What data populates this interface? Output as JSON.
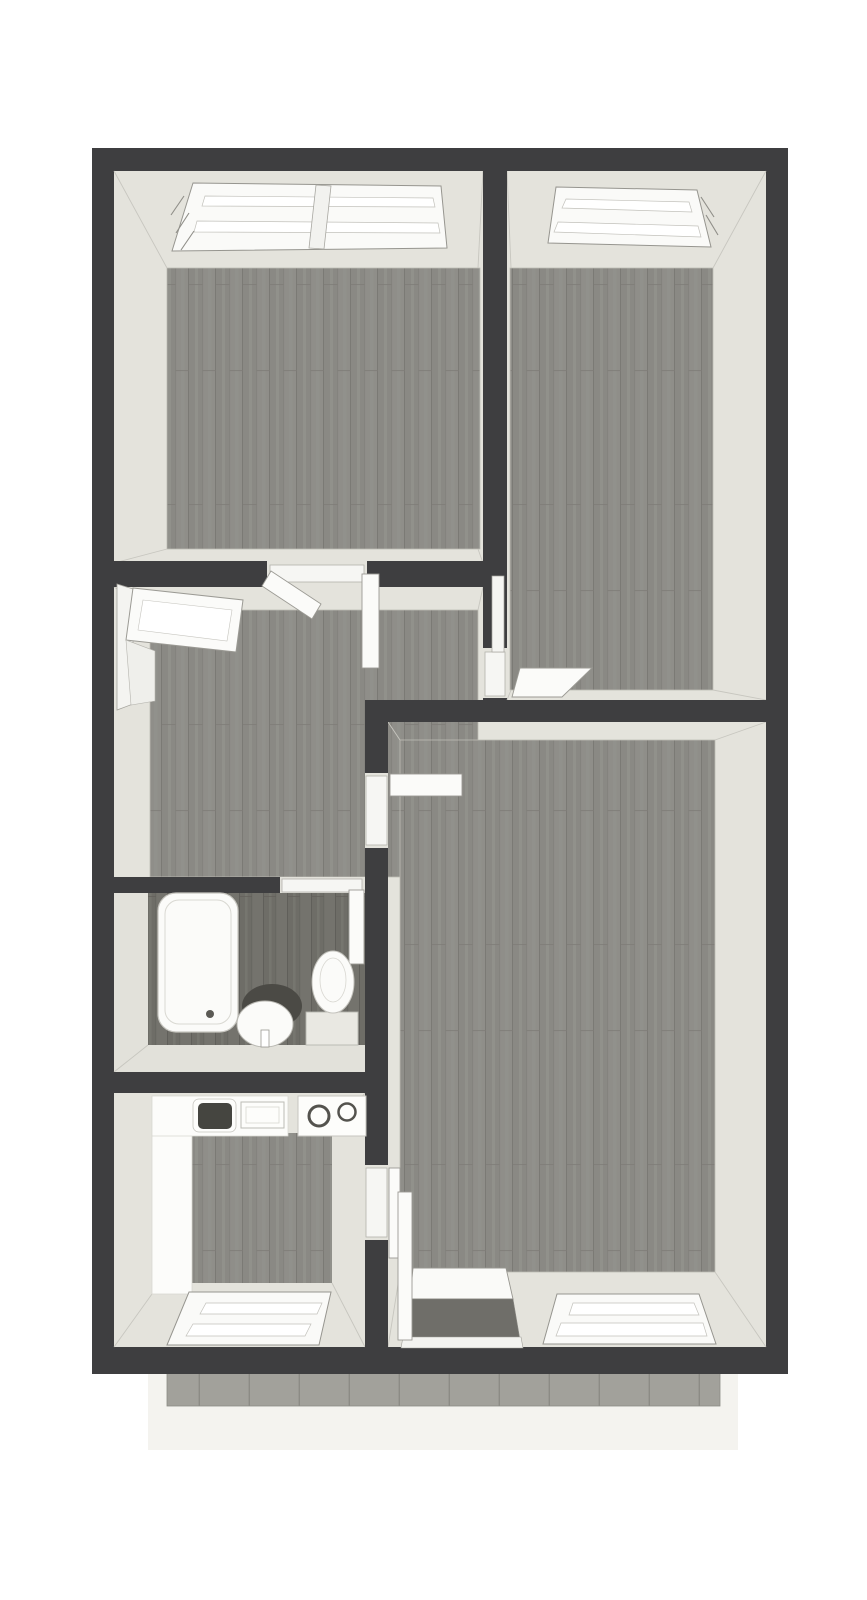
{
  "meta": {
    "type": "3d-floor-plan-top-view",
    "canvas_width": 867,
    "canvas_height": 1600,
    "text_visible": false
  },
  "palette": {
    "wall": "#3e3e40",
    "wall_face": "#e4e3dc",
    "wall_face_dim": "#e2e1da",
    "floor_wood": "#8f8e89",
    "floor_wood_dark": "#74736d",
    "balcony_tile": "#a2a19b",
    "balcony_apron": "#f4f3ef",
    "fixture_white": "#fbfbf9",
    "threshold_white": "#f6f6f3",
    "background": "#ffffff"
  },
  "rooms": [
    {
      "id": "bedroom-top-left",
      "floor": "wood",
      "features": [
        "double-window-north",
        "double-door-to-hall"
      ]
    },
    {
      "id": "bedroom-top-right",
      "floor": "wood",
      "features": [
        "window-north",
        "door-to-hall"
      ]
    },
    {
      "id": "hall",
      "floor": "wood",
      "features": [
        "open-window-west"
      ]
    },
    {
      "id": "bathroom",
      "floor": "wood-dark",
      "features": [
        "bathtub",
        "washbasin",
        "toilet",
        "door-north"
      ]
    },
    {
      "id": "kitchen",
      "floor": "wood",
      "features": [
        "l-shaped-counter",
        "sink-unit",
        "cooktop-two-burners",
        "window-south",
        "door-to-living-room"
      ]
    },
    {
      "id": "living-room",
      "floor": "wood",
      "features": [
        "balcony-door-south",
        "window-south",
        "door-to-hall"
      ]
    },
    {
      "id": "balcony",
      "floor": "tile",
      "features": []
    }
  ],
  "scene": [
    {
      "n": "balcony-apron",
      "s": "rect",
      "x": 148,
      "y": 1372,
      "w": 590,
      "h": 78,
      "f": "#f4f3ef"
    },
    {
      "n": "balcony-tile-floor",
      "s": "rect",
      "x": 167,
      "y": 1372,
      "w": 553,
      "h": 34,
      "f": "pattern:tiles",
      "st": "#8d8c86",
      "sw": 0.8
    },
    {
      "n": "exterior-walls",
      "s": "rect",
      "x": 92,
      "y": 148,
      "w": 696,
      "h": 1226,
      "f": "#3e3e40"
    },
    {
      "n": "bedroom1-wall-faces",
      "s": "rect",
      "x": 114,
      "y": 171,
      "w": 369,
      "h": 392,
      "f": "#e4e3dc"
    },
    {
      "n": "bedroom2-wall-faces",
      "s": "rect",
      "x": 507,
      "y": 171,
      "w": 259,
      "h": 529,
      "f": "#e4e3dc"
    },
    {
      "n": "hall-wall-faces",
      "s": "rect",
      "x": 114,
      "y": 587,
      "w": 369,
      "h": 290,
      "f": "#e4e3dc"
    },
    {
      "n": "bathroom-wall-faces",
      "s": "rect",
      "x": 114,
      "y": 893,
      "w": 274,
      "h": 179,
      "f": "#e2e1da"
    },
    {
      "n": "kitchen-wall-faces",
      "s": "rect",
      "x": 114,
      "y": 1093,
      "w": 274,
      "h": 254,
      "f": "#e4e3dc"
    },
    {
      "n": "living-wall-faces",
      "s": "rect",
      "x": 388,
      "y": 722,
      "w": 378,
      "h": 625,
      "f": "#e4e3dc"
    },
    {
      "n": "bedroom1-floor",
      "s": "rect",
      "x": 167,
      "y": 268,
      "w": 313,
      "h": 281,
      "f": "pattern:wood",
      "st": "#bdbcb5",
      "sw": 0.8
    },
    {
      "n": "bedroom2-floor",
      "s": "rect",
      "x": 510,
      "y": 268,
      "w": 203,
      "h": 422,
      "f": "pattern:wood",
      "st": "#bdbcb5",
      "sw": 0.8
    },
    {
      "n": "hall-floor",
      "s": "rect",
      "x": 150,
      "y": 610,
      "w": 328,
      "h": 267,
      "f": "pattern:wood",
      "st": "#bdbcb5",
      "sw": 0.8
    },
    {
      "n": "bathroom-floor",
      "s": "rect",
      "x": 148,
      "y": 893,
      "w": 217,
      "h": 152,
      "f": "pattern:woodDark"
    },
    {
      "n": "kitchen-floor",
      "s": "rect",
      "x": 192,
      "y": 1133,
      "w": 140,
      "h": 150,
      "f": "pattern:wood"
    },
    {
      "n": "living-floor",
      "s": "rect",
      "x": 400,
      "y": 740,
      "w": 315,
      "h": 532,
      "f": "pattern:wood",
      "st": "#bdbcb5",
      "sw": 0.8
    },
    {
      "n": "corner-seam",
      "s": "line",
      "x1": 114,
      "y1": 171,
      "x2": 167,
      "y2": 268,
      "st": "#c7c6bf",
      "sw": 0.9
    },
    {
      "n": "corner-seam",
      "s": "line",
      "x1": 483,
      "y1": 171,
      "x2": 478,
      "y2": 268,
      "st": "#c7c6bf",
      "sw": 0.9
    },
    {
      "n": "corner-seam",
      "s": "line",
      "x1": 114,
      "y1": 563,
      "x2": 167,
      "y2": 549,
      "st": "#c7c6bf",
      "sw": 0.9
    },
    {
      "n": "corner-seam",
      "s": "line",
      "x1": 483,
      "y1": 563,
      "x2": 478,
      "y2": 549,
      "st": "#c7c6bf",
      "sw": 0.9
    },
    {
      "n": "corner-seam",
      "s": "line",
      "x1": 507,
      "y1": 171,
      "x2": 511,
      "y2": 268,
      "st": "#c7c6bf",
      "sw": 0.9
    },
    {
      "n": "corner-seam",
      "s": "line",
      "x1": 766,
      "y1": 171,
      "x2": 713,
      "y2": 268,
      "st": "#c7c6bf",
      "sw": 0.9
    },
    {
      "n": "corner-seam",
      "s": "line",
      "x1": 766,
      "y1": 700,
      "x2": 713,
      "y2": 690,
      "st": "#c7c6bf",
      "sw": 0.9
    },
    {
      "n": "corner-seam",
      "s": "line",
      "x1": 507,
      "y1": 700,
      "x2": 511,
      "y2": 690,
      "st": "#c7c6bf",
      "sw": 0.9
    },
    {
      "n": "corner-seam",
      "s": "line",
      "x1": 114,
      "y1": 587,
      "x2": 150,
      "y2": 610,
      "st": "#c7c6bf",
      "sw": 0.9
    },
    {
      "n": "corner-seam",
      "s": "line",
      "x1": 483,
      "y1": 587,
      "x2": 478,
      "y2": 610,
      "st": "#c7c6bf",
      "sw": 0.9
    },
    {
      "n": "corner-seam",
      "s": "line",
      "x1": 388,
      "y1": 722,
      "x2": 400,
      "y2": 740,
      "st": "#c7c6bf",
      "sw": 0.9
    },
    {
      "n": "corner-seam",
      "s": "line",
      "x1": 766,
      "y1": 722,
      "x2": 715,
      "y2": 740,
      "st": "#c7c6bf",
      "sw": 0.9
    },
    {
      "n": "corner-seam",
      "s": "line",
      "x1": 766,
      "y1": 1347,
      "x2": 715,
      "y2": 1272,
      "st": "#c7c6bf",
      "sw": 0.9
    },
    {
      "n": "corner-seam",
      "s": "line",
      "x1": 388,
      "y1": 1347,
      "x2": 400,
      "y2": 1272,
      "st": "#c7c6bf",
      "sw": 0.9
    },
    {
      "n": "corner-seam",
      "s": "line",
      "x1": 114,
      "y1": 1072,
      "x2": 148,
      "y2": 1045,
      "st": "#c7c6bf",
      "sw": 0.9
    },
    {
      "n": "corner-seam",
      "s": "line",
      "x1": 365,
      "y1": 1093,
      "x2": 332,
      "y2": 1133,
      "st": "#c7c6bf",
      "sw": 0.9
    },
    {
      "n": "corner-seam",
      "s": "line",
      "x1": 365,
      "y1": 1347,
      "x2": 332,
      "y2": 1283,
      "st": "#c7c6bf",
      "sw": 0.9
    },
    {
      "n": "corner-seam",
      "s": "line",
      "x1": 114,
      "y1": 1347,
      "x2": 152,
      "y2": 1294,
      "st": "#c7c6bf",
      "sw": 0.9
    },
    {
      "n": "wall-bedroom-divider",
      "s": "rect",
      "x": 483,
      "y": 148,
      "w": 24,
      "h": 500,
      "f": "#3e3e40"
    },
    {
      "n": "wall-bedroom1-south-left",
      "s": "rect",
      "x": 114,
      "y": 561,
      "w": 153,
      "h": 26,
      "f": "#3e3e40"
    },
    {
      "n": "wall-bedroom1-south-right",
      "s": "rect",
      "x": 367,
      "y": 561,
      "w": 116,
      "h": 26,
      "f": "#3e3e40"
    },
    {
      "n": "wall-living-north",
      "s": "rect",
      "x": 365,
      "y": 700,
      "w": 423,
      "h": 22,
      "f": "#3e3e40"
    },
    {
      "n": "wall-hall-living-upper",
      "s": "rect",
      "x": 365,
      "y": 722,
      "w": 23,
      "h": 51,
      "f": "#3e3e40"
    },
    {
      "n": "wall-hall-living-mid",
      "s": "rect",
      "x": 365,
      "y": 848,
      "w": 23,
      "h": 317,
      "f": "#3e3e40"
    },
    {
      "n": "wall-kitchen-living-lower",
      "s": "rect",
      "x": 365,
      "y": 1240,
      "w": 23,
      "h": 107,
      "f": "#3e3e40"
    },
    {
      "n": "wall-bathroom-north",
      "s": "rect",
      "x": 114,
      "y": 877,
      "w": 166,
      "h": 16,
      "f": "#3e3e40"
    },
    {
      "n": "wall-bathroom-south",
      "s": "rect",
      "x": 114,
      "y": 1072,
      "w": 251,
      "h": 21,
      "f": "#3e3e40"
    },
    {
      "n": "doorway-bedroom1",
      "s": "rect",
      "x": 267,
      "y": 561,
      "w": 100,
      "h": 26,
      "f": "#e4e3dc"
    },
    {
      "n": "doorway-bedroom1-threshold",
      "s": "rect",
      "x": 270,
      "y": 565,
      "w": 94,
      "h": 17,
      "f": "#f6f6f3",
      "st": "#b3b2ac",
      "sw": 0.8
    },
    {
      "n": "doorway-bedroom2",
      "s": "rect",
      "x": 483,
      "y": 648,
      "w": 24,
      "h": 50,
      "f": "#e4e3dc"
    },
    {
      "n": "doorway-bedroom2-threshold",
      "s": "rect",
      "x": 485,
      "y": 652,
      "w": 20,
      "h": 44,
      "f": "#f6f6f3",
      "st": "#b3b2ac",
      "sw": 0.8
    },
    {
      "n": "doorway-bedroom2-frame",
      "s": "rect",
      "x": 492,
      "y": 576,
      "w": 12,
      "h": 76,
      "f": "#f5f5f2",
      "st": "#a5a49e",
      "sw": 0.7
    },
    {
      "n": "doorway-hall-living",
      "s": "rect",
      "x": 365,
      "y": 773,
      "w": 23,
      "h": 75,
      "f": "#e4e3dc"
    },
    {
      "n": "doorway-hall-living-threshold",
      "s": "rect",
      "x": 366,
      "y": 776,
      "w": 21,
      "h": 69,
      "f": "#f6f6f3",
      "st": "#b3b2ac",
      "sw": 0.8
    },
    {
      "n": "doorway-kitchen-living",
      "s": "rect",
      "x": 365,
      "y": 1165,
      "w": 23,
      "h": 75,
      "f": "#e4e3dc"
    },
    {
      "n": "doorway-kitchen-living-threshold",
      "s": "rect",
      "x": 366,
      "y": 1168,
      "w": 21,
      "h": 69,
      "f": "#f6f6f3",
      "st": "#b3b2ac",
      "sw": 0.8
    },
    {
      "n": "doorway-bathroom",
      "s": "rect",
      "x": 280,
      "y": 877,
      "w": 85,
      "h": 16,
      "f": "#e2e1da"
    },
    {
      "n": "doorway-bathroom-threshold",
      "s": "rect",
      "x": 282,
      "y": 879,
      "w": 80,
      "h": 13,
      "f": "#f6f6f3",
      "st": "#b3b2ac",
      "sw": 0.8
    },
    {
      "n": "bedroom1-window-frame",
      "s": "poly",
      "p": "193,183 441,186 447,248 172,251",
      "f": "#fafaf8",
      "st": "#96958f",
      "sw": 1
    },
    {
      "n": "bedroom1-window-rail-top",
      "s": "poly",
      "p": "205,196 433,198 435,207 202,206",
      "f": "#ffffff",
      "st": "#c2c1bb",
      "sw": 0.7
    },
    {
      "n": "bedroom1-window-rail-bottom",
      "s": "poly",
      "p": "197,221 438,223 440,233 194,232",
      "f": "#ffffff",
      "st": "#c2c1bb",
      "sw": 0.7
    },
    {
      "n": "bedroom1-window-mullion",
      "s": "poly",
      "p": "316,185 331,186 324,249 309,248",
      "f": "#f2f2ef",
      "st": "#a8a7a1",
      "sw": 0.8
    },
    {
      "n": "window-jamb-tick",
      "s": "line",
      "x1": 184,
      "y1": 196,
      "x2": 171,
      "y2": 215,
      "st": "#8f8e88",
      "sw": 1.1
    },
    {
      "n": "window-jamb-tick",
      "s": "line",
      "x1": 189,
      "y1": 213,
      "x2": 176,
      "y2": 233,
      "st": "#8f8e88",
      "sw": 1.1
    },
    {
      "n": "window-jamb-tick",
      "s": "line",
      "x1": 194,
      "y1": 231,
      "x2": 181,
      "y2": 250,
      "st": "#8f8e88",
      "sw": 1.1
    },
    {
      "n": "bedroom2-window-frame",
      "s": "poly",
      "p": "556,187 697,190 711,247 548,243",
      "f": "#fafaf8",
      "st": "#96958f",
      "sw": 1
    },
    {
      "n": "bedroom2-window-rail-top",
      "s": "poly",
      "p": "566,199 689,202 692,212 562,208",
      "f": "#ffffff",
      "st": "#c2c1bb",
      "sw": 0.7
    },
    {
      "n": "bedroom2-window-rail-bottom",
      "s": "poly",
      "p": "558,222 698,226 701,237 554,232",
      "f": "#ffffff",
      "st": "#c2c1bb",
      "sw": 0.7
    },
    {
      "n": "window-jamb-tick",
      "s": "line",
      "x1": 701,
      "y1": 197,
      "x2": 714,
      "y2": 217,
      "st": "#8f8e88",
      "sw": 1.1
    },
    {
      "n": "window-jamb-tick",
      "s": "line",
      "x1": 706,
      "y1": 215,
      "x2": 718,
      "y2": 235,
      "st": "#8f8e88",
      "sw": 1.1
    },
    {
      "n": "hall-window-jamb",
      "s": "poly",
      "p": "117,584 133,589 133,704 117,710",
      "f": "#f4f4f1",
      "st": "#a5a49e",
      "sw": 0.8
    },
    {
      "n": "hall-window-open-sash",
      "s": "poly",
      "p": "133,588 243,600 236,652 126,640",
      "f": "#fbfbf9",
      "st": "#9b9a94",
      "sw": 1
    },
    {
      "n": "hall-window-sash-glass",
      "s": "poly",
      "p": "143,600 232,610 227,641 138,630",
      "f": "#ffffff",
      "st": "#c5c4be",
      "sw": 0.6
    },
    {
      "n": "hall-window-reveal",
      "s": "poly",
      "p": "126,640 155,651 155,701 131,705",
      "f": "#efefeb",
      "st": "#b5b4ae",
      "sw": 0.6
    },
    {
      "n": "bedroom1-door-leaf-left",
      "s": "poly",
      "p": "271,571 321,604 312,619 262,586",
      "f": "#fbfbf9",
      "st": "#9b9a94",
      "sw": 0.9
    },
    {
      "n": "bedroom1-door-leaf-right",
      "s": "rect",
      "x": 362,
      "y": 574,
      "w": 17,
      "h": 94,
      "f": "#fbfbf9",
      "st": "#9b9a94",
      "sw": 0.9
    },
    {
      "n": "bedroom2-door-leaf",
      "s": "poly",
      "p": "520,668 592,668 562,697 512,697",
      "f": "#fbfbf9",
      "st": "#9b9a94",
      "sw": 0.9
    },
    {
      "n": "hall-living-door-leaf",
      "s": "rect",
      "x": 390,
      "y": 774,
      "w": 72,
      "h": 22,
      "f": "#fbfbf9",
      "st": "#9b9a94",
      "sw": 0.9
    },
    {
      "n": "bathroom-door-leaf",
      "s": "rect",
      "x": 349,
      "y": 890,
      "w": 15,
      "h": 74,
      "f": "#fbfbf9",
      "st": "#9b9a94",
      "sw": 0.9
    },
    {
      "n": "kitchen-door-leaf",
      "s": "rect",
      "x": 389,
      "y": 1168,
      "w": 11,
      "h": 90,
      "f": "#fbfbf9",
      "st": "#9b9a94",
      "sw": 0.9
    },
    {
      "n": "bathtub",
      "s": "rect",
      "x": 158,
      "y": 893,
      "w": 80,
      "h": 139,
      "rx": 18,
      "f": "#fbfbf9",
      "st": "#c7c6c0",
      "sw": 1.2
    },
    {
      "n": "bathtub-inner-rim",
      "s": "rect",
      "x": 165,
      "y": 900,
      "w": 66,
      "h": 124,
      "rx": 14,
      "f": "none",
      "st": "#d9d8d2",
      "sw": 1
    },
    {
      "n": "bathtub-drain",
      "s": "circle",
      "cx": 210,
      "cy": 1014,
      "r": 4,
      "f": "#5b5a55"
    },
    {
      "n": "washbasin-backsplash",
      "s": "ellipse",
      "cx": 272,
      "cy": 1006,
      "rx": 30,
      "ry": 22,
      "f": "#4b4a45"
    },
    {
      "n": "washbasin-bowl",
      "s": "ellipse",
      "cx": 265,
      "cy": 1024,
      "rx": 28,
      "ry": 23,
      "f": "#fbfbf9",
      "st": "#b9b8b2",
      "sw": 1
    },
    {
      "n": "washbasin-tap",
      "s": "rect",
      "x": 261,
      "y": 1030,
      "w": 8,
      "h": 17,
      "f": "#ffffff",
      "st": "#9b9a94",
      "sw": 0.8
    },
    {
      "n": "toilet-base",
      "s": "rect",
      "x": 306,
      "y": 1012,
      "w": 52,
      "h": 33,
      "f": "#e9e8e2",
      "st": "#b7b6b0",
      "sw": 0.9
    },
    {
      "n": "toilet-bowl",
      "s": "ellipse",
      "cx": 333,
      "cy": 982,
      "rx": 21,
      "ry": 31,
      "f": "#fbfbf9",
      "st": "#c4c3bd",
      "sw": 1
    },
    {
      "n": "toilet-bowl-inner",
      "s": "ellipse",
      "cx": 333,
      "cy": 980,
      "rx": 13,
      "ry": 22,
      "f": "none",
      "st": "#d8d7d1",
      "sw": 0.8
    },
    {
      "n": "kitchen-counter-left",
      "s": "rect",
      "x": 152,
      "y": 1096,
      "w": 40,
      "h": 198,
      "f": "#fcfcfa",
      "st": "#d8d7d1",
      "sw": 0.8
    },
    {
      "n": "kitchen-counter-top",
      "s": "rect",
      "x": 152,
      "y": 1096,
      "w": 136,
      "h": 40,
      "f": "#fcfcfa",
      "st": "#d8d7d1",
      "sw": 0.8
    },
    {
      "n": "kitchen-sink-unit",
      "s": "rect",
      "x": 193,
      "y": 1099,
      "w": 43,
      "h": 33,
      "rx": 6,
      "f": "#fdfdfb",
      "st": "#c6c5bf",
      "sw": 0.8
    },
    {
      "n": "kitchen-sink-basin",
      "s": "rect",
      "x": 198,
      "y": 1103,
      "w": 34,
      "h": 26,
      "rx": 5,
      "f": "#454540"
    },
    {
      "n": "kitchen-drainboard",
      "s": "rect",
      "x": 241,
      "y": 1102,
      "w": 43,
      "h": 26,
      "f": "#fdfdfb",
      "st": "#bcbbb5",
      "sw": 1
    },
    {
      "n": "kitchen-drainboard-inner",
      "s": "rect",
      "x": 246,
      "y": 1107,
      "w": 33,
      "h": 16,
      "f": "none",
      "st": "#d8d7d1",
      "sw": 0.8
    },
    {
      "n": "kitchen-stove",
      "s": "rect",
      "x": 298,
      "y": 1096,
      "w": 68,
      "h": 40,
      "f": "#fdfdfb",
      "st": "#c6c5bf",
      "sw": 1
    },
    {
      "n": "stove-burner-left",
      "s": "circle",
      "cx": 319,
      "cy": 1116,
      "r": 10,
      "f": "#fdfdfb",
      "st": "#54534e",
      "sw": 3
    },
    {
      "n": "stove-burner-right",
      "s": "circle",
      "cx": 347,
      "cy": 1112,
      "r": 8.5,
      "f": "#fdfdfb",
      "st": "#54534e",
      "sw": 2.5
    },
    {
      "n": "balcony-door-sill",
      "s": "poly",
      "p": "413,1268 506,1268 513,1299 410,1299",
      "f": "#fafaf8",
      "st": "#96958f",
      "sw": 0.9
    },
    {
      "n": "balcony-door-glass",
      "s": "poly",
      "p": "410,1299 513,1299 520,1340 404,1340",
      "f": "#6f6e69",
      "st": "#8a8984",
      "sw": 0.6
    },
    {
      "n": "balcony-door-bottom-rail",
      "s": "poly",
      "p": "403,1337 521,1337 523,1348 401,1348",
      "f": "#f3f3f0",
      "st": "#a09f99",
      "sw": 0.6
    },
    {
      "n": "balcony-door-open-leaf",
      "s": "rect",
      "x": 398,
      "y": 1192,
      "w": 14,
      "h": 148,
      "f": "#fbfbf9",
      "st": "#9b9a94",
      "sw": 0.9
    },
    {
      "n": "living-window-frame",
      "s": "poly",
      "p": "557,1294 699,1294 716,1344 543,1344",
      "f": "#fafaf8",
      "st": "#96958f",
      "sw": 1
    },
    {
      "n": "living-window-rail-top",
      "s": "poly",
      "p": "573,1303 694,1303 699,1315 569,1315",
      "f": "#ffffff",
      "st": "#c2c1bb",
      "sw": 0.7
    },
    {
      "n": "living-window-rail-bottom",
      "s": "poly",
      "p": "561,1323 703,1323 707,1336 556,1336",
      "f": "#ffffff",
      "st": "#c2c1bb",
      "sw": 0.7
    },
    {
      "n": "kitchen-window-frame",
      "s": "poly",
      "p": "189,1292 331,1292 319,1345 167,1345",
      "f": "#fafaf8",
      "st": "#96958f",
      "sw": 1
    },
    {
      "n": "kitchen-window-rail-top",
      "s": "poly",
      "p": "206,1303 322,1303 317,1314 200,1314",
      "f": "#ffffff",
      "st": "#c2c1bb",
      "sw": 0.7
    },
    {
      "n": "kitchen-window-rail-bottom",
      "s": "poly",
      "p": "193,1324 311,1324 305,1336 186,1336",
      "f": "#ffffff",
      "st": "#c2c1bb",
      "sw": 0.7
    }
  ]
}
